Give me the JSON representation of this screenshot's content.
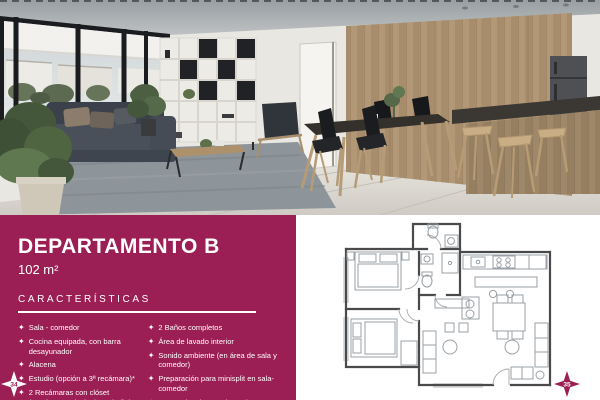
{
  "accent_color": "#9B1E54",
  "panel": {
    "title": "DEPARTAMENTO B",
    "area": "102 m²",
    "section_title": "CARACTERÍSTICAS",
    "features_left": [
      "Sala - comedor",
      "Cocina equipada, con barra desayunador",
      "Alacena",
      "Estudio (opción a 3ª recámara)*",
      "2 Recámaras con clóset (Recámara principal con baño)"
    ],
    "features_right": [
      "2 Baños completos",
      "Área de lavado interior",
      "Sonido ambiente (en área de sala y comedor)",
      "Preparación para minisplit en sala-comedor",
      "2 Espacios de estacionamientos"
    ]
  },
  "page": {
    "left_page_number": "34",
    "right_page_number": "35"
  },
  "icons": {
    "diamond_bullet": "✦"
  }
}
